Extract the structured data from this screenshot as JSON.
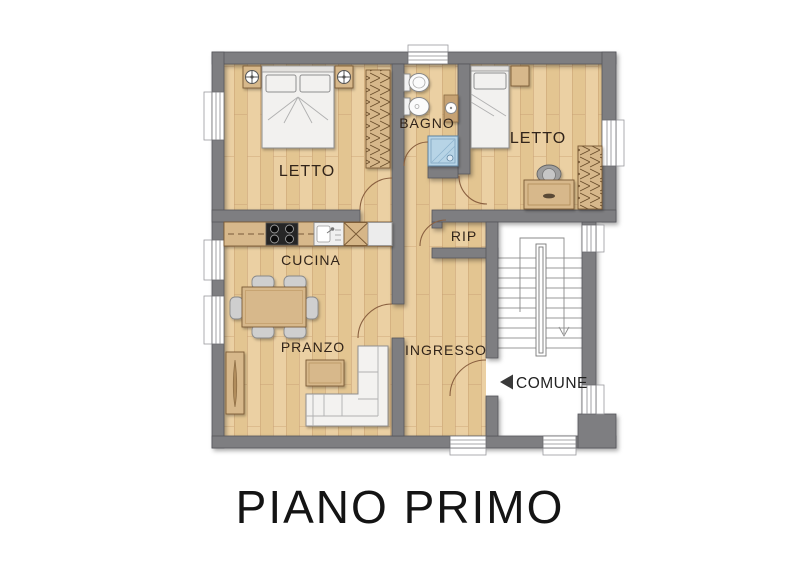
{
  "title": "PIANO PRIMO",
  "plan": {
    "rooms": {
      "letto1": {
        "label": "LETTO"
      },
      "bagno": {
        "label": "BAGNO"
      },
      "letto2": {
        "label": "LETTO"
      },
      "rip": {
        "label": "RIP"
      },
      "cucina": {
        "label": "CUCINA"
      },
      "pranzo": {
        "label": "PRANZO"
      },
      "ingresso": {
        "label": "INGRESSO"
      },
      "comune": {
        "label": "COMUNE"
      }
    },
    "icons": {
      "comune_arrow": "left-triangle",
      "stairs_down_arrow": "chevron-down",
      "nightstand_lamp": "crosshair-circle"
    },
    "colors": {
      "wall": "#7e7e81",
      "wall_outline": "#55555a",
      "floor_light": "#ebd0a3",
      "floor_dark": "#e3c591",
      "floor_line": "#c9a173",
      "furniture_wood": "#d7b88b",
      "furniture_wood_outline": "#7a5a36",
      "white_furniture": "#f2f1ef",
      "shower_blue": "#b7d4e6",
      "stair_floor": "#ffffff",
      "label_text": "#31241a",
      "title_text": "#141414",
      "door_arc": "#8a6040"
    }
  }
}
